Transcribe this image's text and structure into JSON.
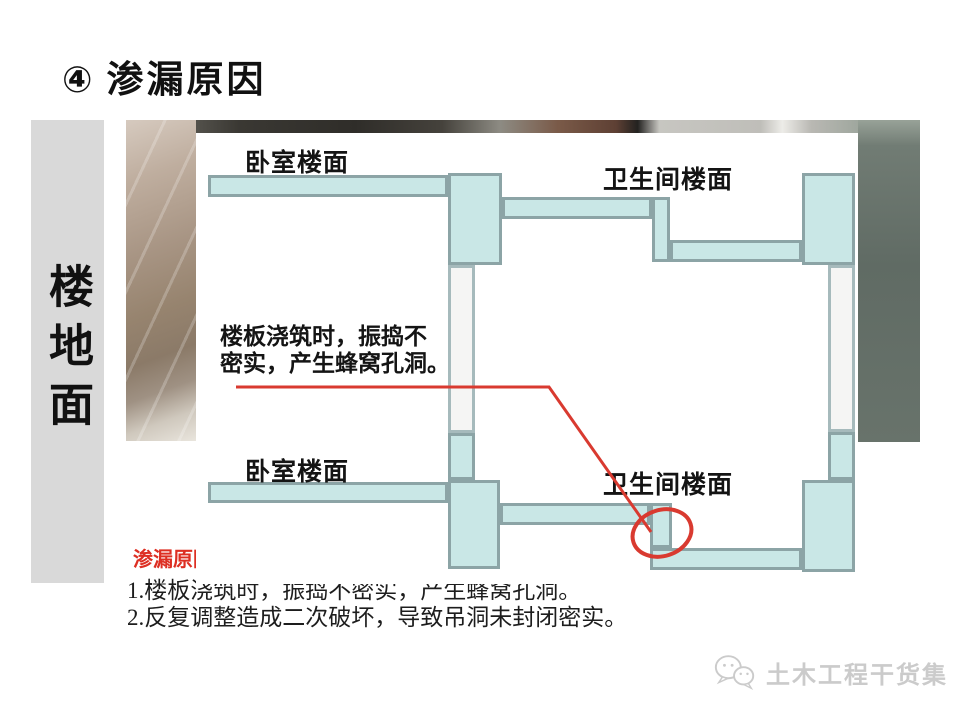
{
  "slide": {
    "title": {
      "badge": "④",
      "text": "渗漏原因"
    },
    "sidebar_label": "楼地面"
  },
  "diagram": {
    "label_bedroom_top": "卧室楼面",
    "label_bathroom_top": "卫生间楼面",
    "label_bedroom_bottom": "卧室楼面",
    "label_bathroom_bottom": "卫生间楼面",
    "annotation_line1": "楼板浇筑时，振捣不",
    "annotation_line2": "密实，产生蜂窝孔洞。",
    "colors": {
      "slab_fill": "#c9e7e6",
      "slab_border": "#8ca4a6",
      "wall_fill": "#f5f5f4",
      "wall_border": "#a6babc",
      "highlight_red": "#d93a30"
    }
  },
  "notes": {
    "heading": "渗漏原因",
    "heading_color": "#dd2f23",
    "item1": "1.楼板浇筑时，振捣不密实，产生蜂窝孔洞。",
    "item2": "2.反复调整造成二次破坏，导致吊洞未封闭密实。"
  },
  "watermark": {
    "text": "土木工程干货集"
  }
}
